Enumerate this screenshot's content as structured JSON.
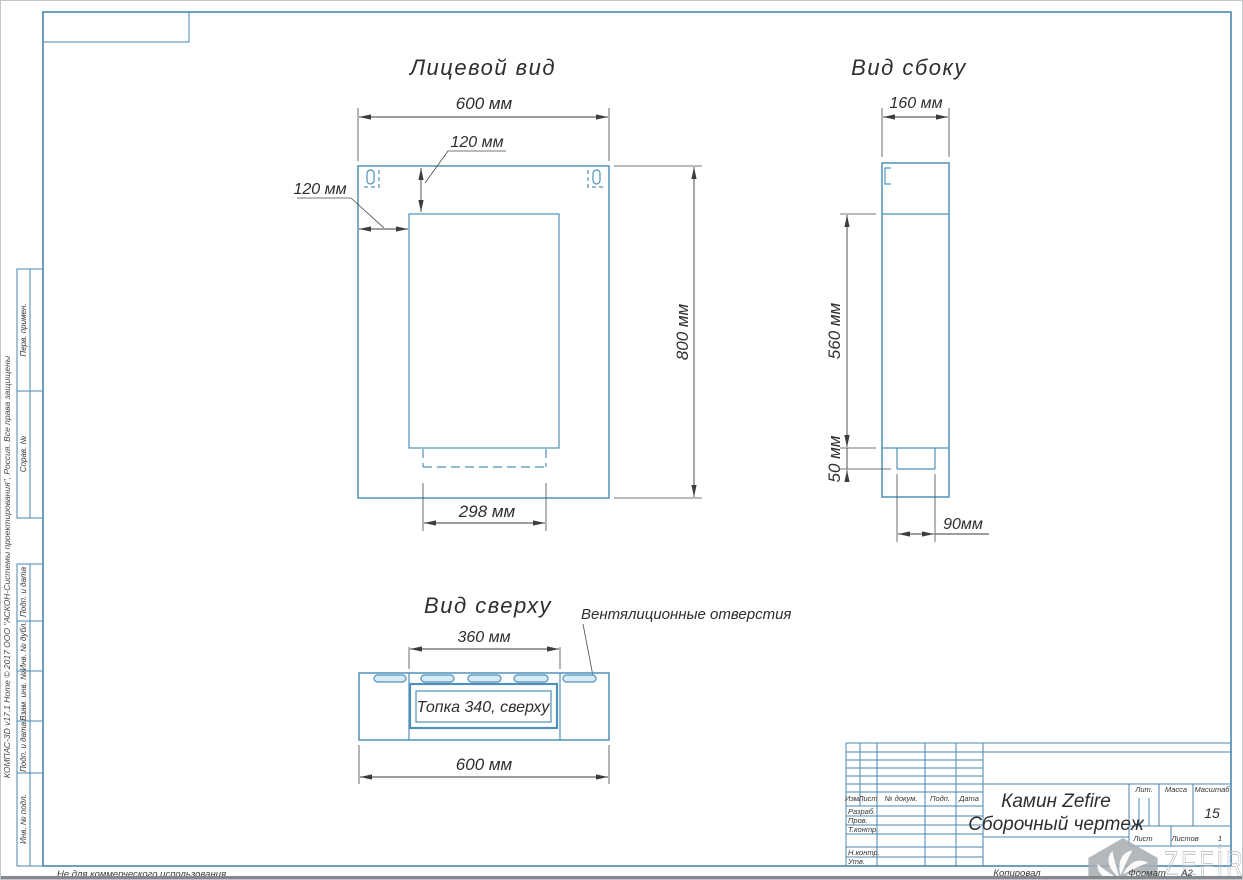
{
  "frame": {
    "copyright": "КОМПАС-3D v17.1 Home © 2017 ООО \"АСКОН-Системы проектирования\", Россия. Все права защищены",
    "not_commercial": "Не для коммерческого использования"
  },
  "sidebar_cells": [
    {
      "label": "Перв. примен."
    },
    {
      "label": "Справ. №"
    },
    {
      "label": "Подп. и дата"
    },
    {
      "label": "Инв. № дубл."
    },
    {
      "label": "Взам. инв. №"
    },
    {
      "label": "Подп. и дата"
    },
    {
      "label": "Инв. № подл."
    }
  ],
  "views": {
    "front": {
      "title": "Лицевой вид",
      "width": "600 мм",
      "top_offset": "120 мм",
      "left_offset": "120 мм",
      "height": "800 мм",
      "opening_width": "298 мм"
    },
    "side": {
      "title": "Вид сбоку",
      "depth": "160 мм",
      "body_height": "560 мм",
      "base_height": "50 мм",
      "base_depth": "90мм"
    },
    "top": {
      "title": "Вид сверху",
      "inner_width": "360 мм",
      "width": "600 мм",
      "firebox": "Топка 340, сверху",
      "vents": "Вентялиционные отверстия"
    }
  },
  "title_block": {
    "cols": {
      "izm": "Изм.",
      "list": "Лист",
      "doc": "№ докум.",
      "podp": "Подп.",
      "data": "Дата"
    },
    "rows": {
      "razrab": "Разраб.",
      "prov": "Пров.",
      "tkontr": "Т.контр.",
      "nkontr": "Н.контр.",
      "utv": "Утв."
    },
    "name_line1": "Камин Zefire",
    "name_line2": "Сборочный чертеж",
    "lit": "Лит.",
    "massa": "Масса",
    "masshtab": "Масштаб",
    "scale": "15",
    "list_label": "Лист",
    "listov_label": "Листов",
    "sheets": "1",
    "kopiroval": "Копировал",
    "format_label": "Формат",
    "format": "А2"
  },
  "logo": {
    "text": "ZEFİRE"
  },
  "colors": {
    "drawing_blue": "#4f90ba",
    "table_blue": "#4b87b0",
    "dimension_dark": "#3d3d3d",
    "slot_fill": "#d9ecf5",
    "logo_gray": "#a9aeb4"
  }
}
